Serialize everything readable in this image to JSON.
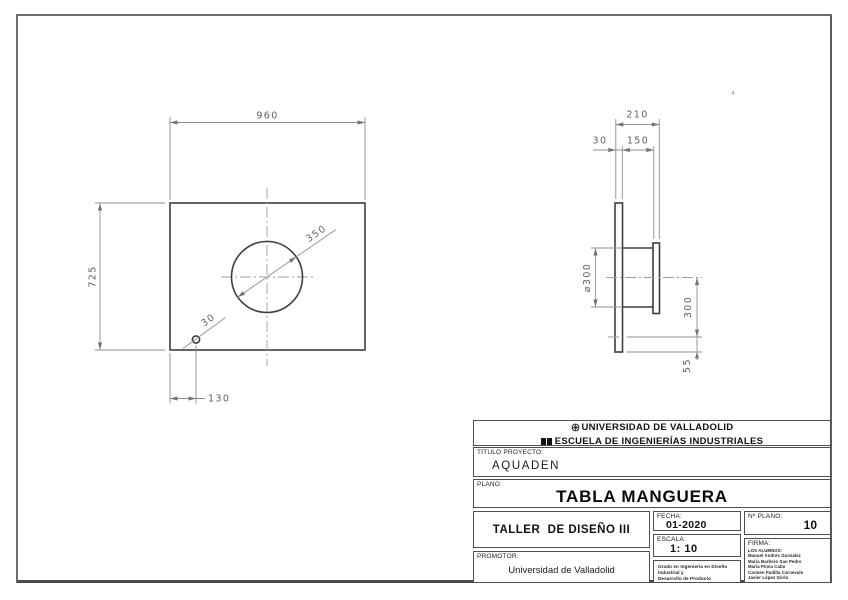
{
  "front_view": {
    "dims": {
      "width": "960",
      "height": "725",
      "circle_diameter": "350",
      "hole_diameter": "30",
      "hole_offset": "130"
    }
  },
  "side_view": {
    "dims": {
      "total_depth": "210",
      "plate_thickness": "30",
      "cylinder_length": "150",
      "cylinder_diameter": "⌀300",
      "center_to_hole": "300",
      "hole_to_edge": "55"
    }
  },
  "stray_mark": "4",
  "title_block": {
    "university_line1": "UNIVERSIDAD DE VALLADOLID",
    "university_line2": "ESCUELA DE INGENIERÍAS INDUSTRIALES",
    "titulo_proyecto_label": "TITULO PROYECTO:",
    "titulo_proyecto_value": "AQUADEN",
    "plano_label": "PLANO:",
    "plano_value": "TABLA MANGUERA",
    "taller_value": "TALLER  DE DISEÑO III",
    "fecha_label": "FECHA:",
    "fecha_value": "01-2020",
    "escala_label": "ESCALA:",
    "escala_value": "1: 10",
    "nplano_label": "Nº PLANO:",
    "nplano_value": "10",
    "firma_label": "FIRMA:",
    "firma_lines": [
      "LOS ALUMNOS:",
      "Manuel Andrés González",
      "María Barbero San Pedro",
      "María Pínea Cabo",
      "Carmen Padilla Carnevale",
      "Javier López Girón"
    ],
    "promotor_label": "PROMOTOR:",
    "promotor_value": "Universidad de Valladolid",
    "grado_line1": "Grado en Ingeniería en Diseño Industrial y",
    "grado_line2": "Desarrollo de Producto"
  },
  "colors": {
    "edge": "#3e3e3e",
    "dimension": "#8f8f8f",
    "text": "#5f5f5f"
  }
}
